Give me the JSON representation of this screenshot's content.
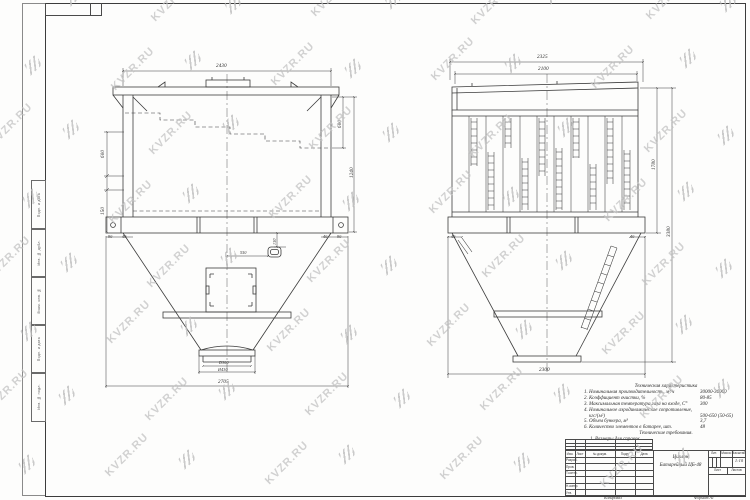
{
  "page": {
    "watermark_text": "KVZR.RU"
  },
  "front_view": {
    "dims": {
      "top_width": "2430",
      "left_upper": "600",
      "left_lower": "150",
      "right_upper": "600",
      "right_total": "1240",
      "foot_left_outer": "90",
      "foot_left_inner": "40",
      "foot_right_inner": "40",
      "foot_right_outer": "90",
      "door_offset": "550",
      "hole_offset": "130",
      "outlet_inner": "D300",
      "outlet_flange": "Ø430",
      "base_width": "2705"
    }
  },
  "side_view": {
    "dims": {
      "top_width": "2325",
      "cover_width": "2100",
      "foot_left": "40",
      "foot_right": "40",
      "body_height": "1780",
      "total_height": "3380",
      "base_width": "2300"
    }
  },
  "tech_spec": {
    "title": "Техническая характеристика",
    "rows": [
      {
        "label": "1. Номинальная производительность, м³/ч",
        "value": "30000-36000"
      },
      {
        "label": "2. Коэффициент очистки, %",
        "value": "80-85"
      },
      {
        "label": "3. Максимальная температура газа на входе, С°",
        "value": "300"
      },
      {
        "label": "4. Номинальное аэродинамическое сопротивление,",
        "value": ""
      },
      {
        "label": "    кгс/(м²)",
        "value": "500-650 (50-65)"
      },
      {
        "label": "5. Объем бункера, м³",
        "value": "3,7"
      },
      {
        "label": "6. Количество элементов в батарее, шт.",
        "value": "48"
      }
    ],
    "req_title": "Технические требования.",
    "req_item": "1. Размеры для справок."
  },
  "title_block": {
    "doc_name_line1": "Циклон",
    "doc_name_line2": "Батарейный ЦБ-48",
    "header_cells": [
      "Изм.",
      "Лист",
      "№ докум.",
      "Подп.",
      "Дата"
    ],
    "signature_rows": [
      "Разраб.",
      "Пров.",
      "Т.контр.",
      "",
      "Н.контр.",
      "Утв."
    ],
    "lit_label": "Лит.",
    "mass_label": "Масса",
    "scale_label": "Масштаб",
    "scale_value": "1:10",
    "sheet_label": "Лист",
    "sheets_label": "Листов",
    "copied_label": "Копировал",
    "format_label": "Формат А1"
  },
  "margin_labels": [
    "Подп. и дата",
    "Инв. № дубл.",
    "Взам. инв. №",
    "Подп. и дата",
    "Инв. № подл."
  ]
}
